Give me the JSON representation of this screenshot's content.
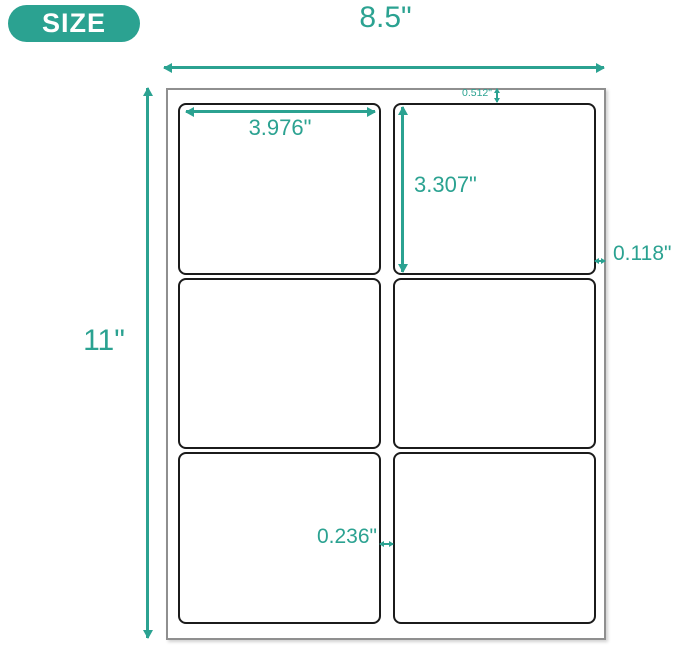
{
  "size_badge": {
    "label": "SIZE"
  },
  "dimensions": {
    "sheet_width": "8.5\"",
    "sheet_height": "11\"",
    "label_width": "3.976\"",
    "label_height": "3.307\"",
    "top_margin": "0.512\"",
    "side_margin": "0.118\"",
    "center_gap": "0.236\""
  },
  "sheet": {
    "columns": 2,
    "rows": 3,
    "label_count": 6
  },
  "icons": {
    "horizontal_double_arrow": "left-right-arrow",
    "vertical_double_arrow": "up-down-arrow"
  },
  "colors": {
    "accent_teal": "#2BA291",
    "badge_text": "#FFFFFF",
    "label_border": "#1B1B1B",
    "sheet_border": "#8F8F8F",
    "background": "#FFFFFF"
  }
}
